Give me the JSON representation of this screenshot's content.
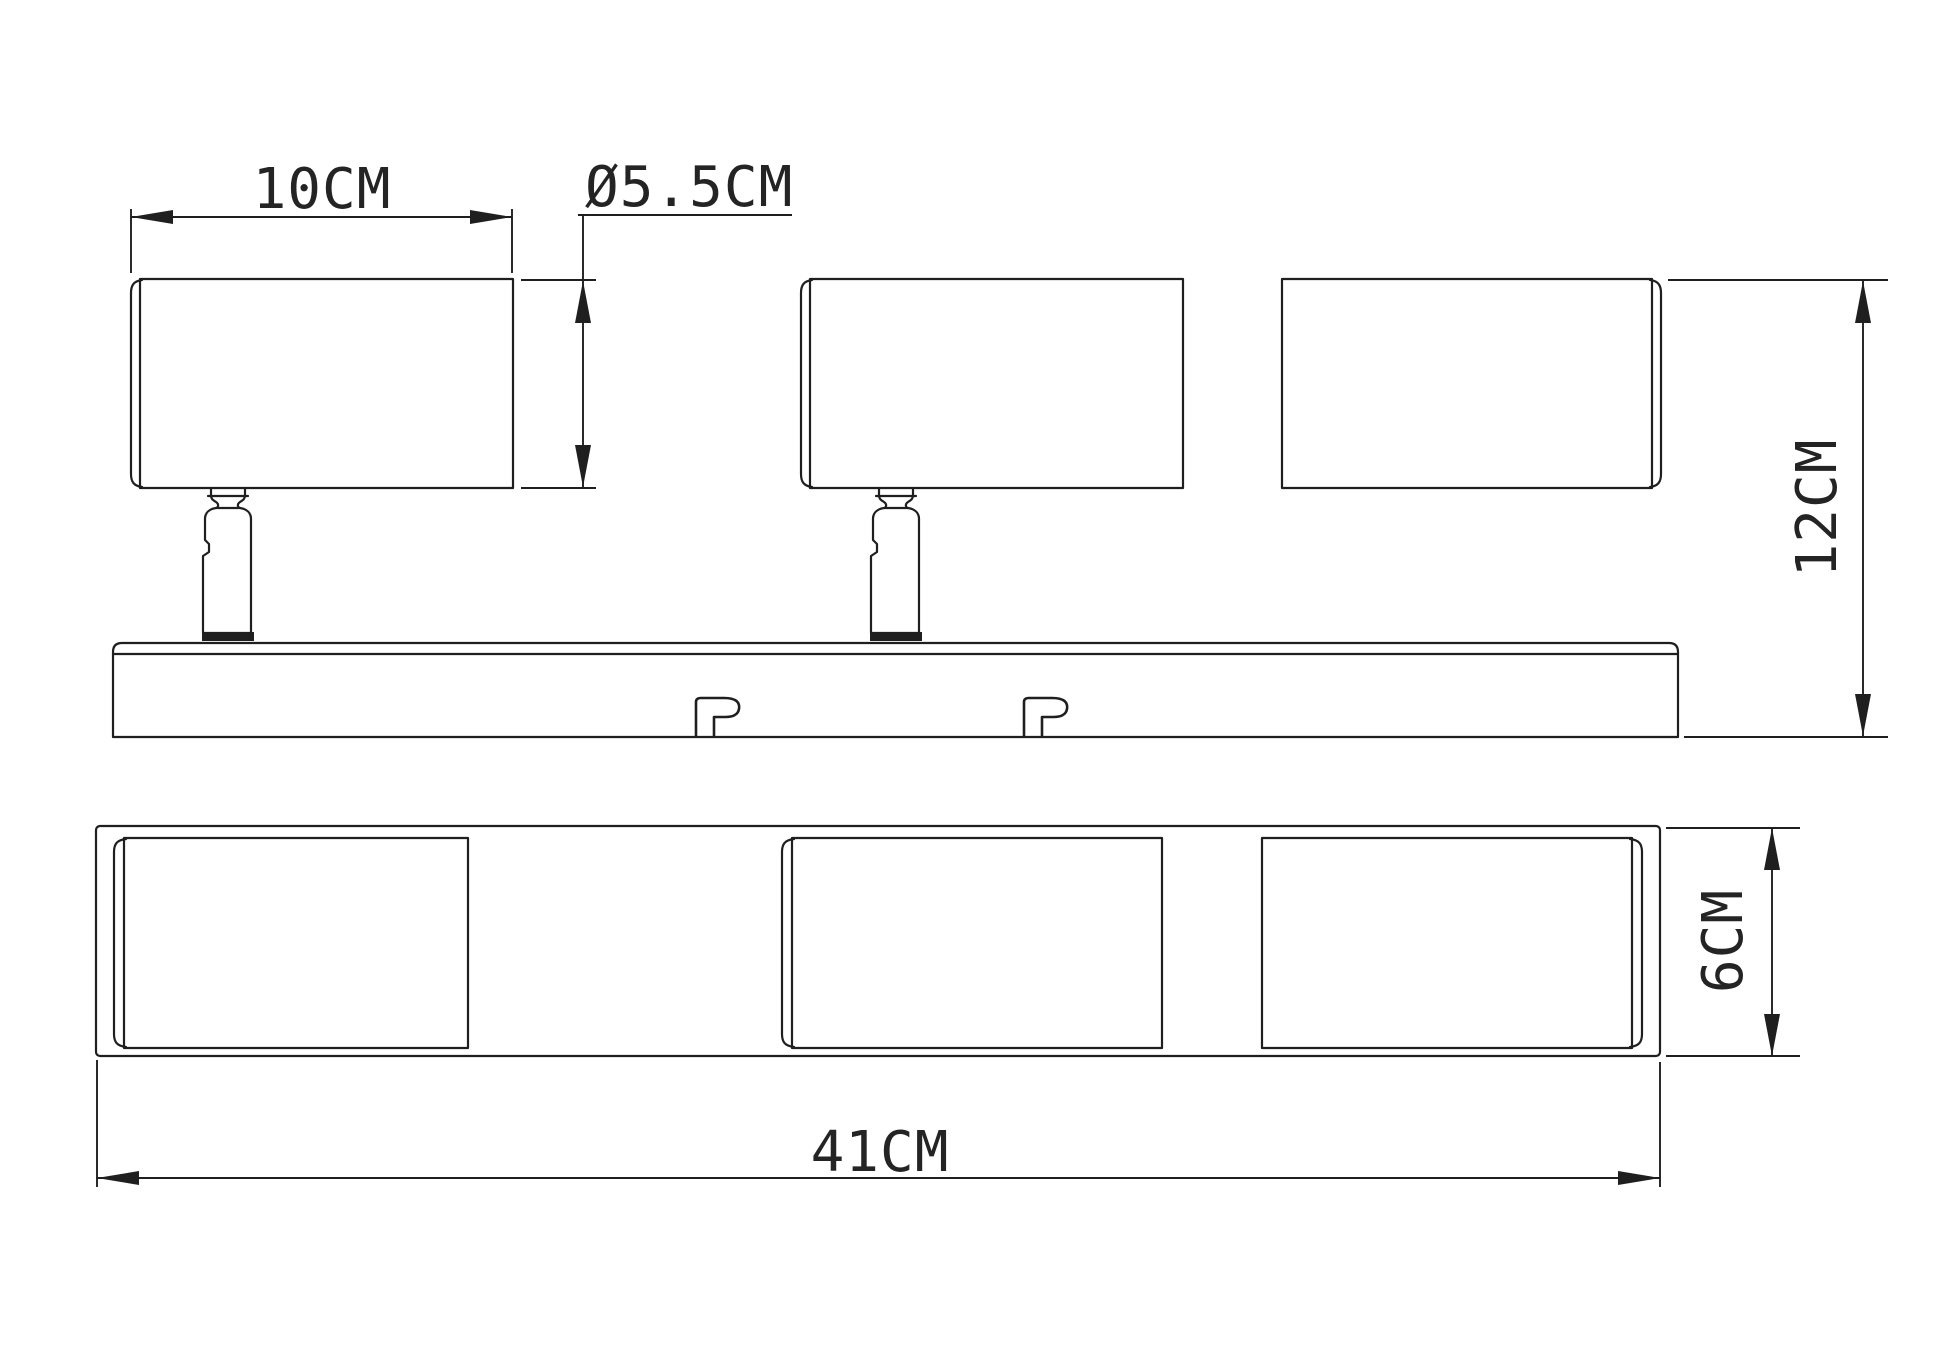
{
  "drawing": {
    "background": "#ffffff",
    "line_color": "#1f1f1f",
    "text_color": "#242424",
    "dimensions": {
      "head_width": "10CM",
      "head_diameter": "Ø5.5CM",
      "total_height": "12CM",
      "total_length": "41CM",
      "bar_depth": "6CM"
    }
  }
}
